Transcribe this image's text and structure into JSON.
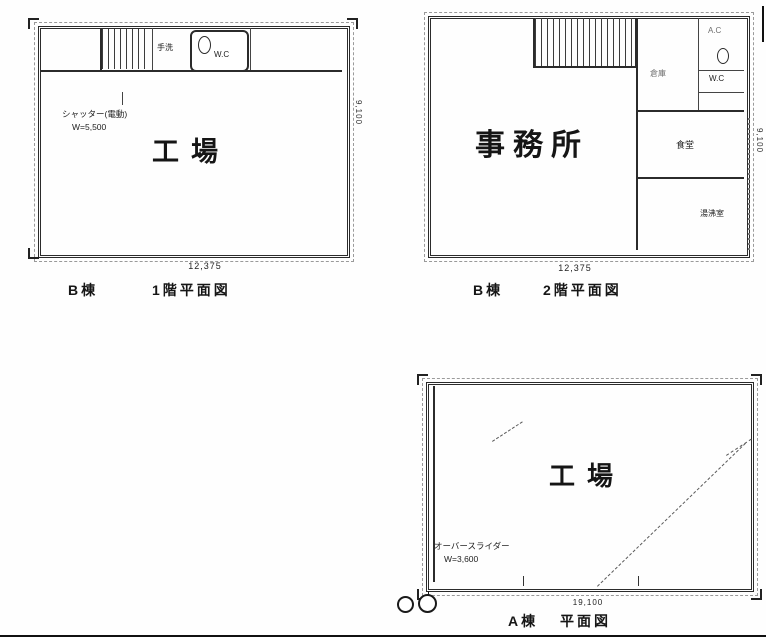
{
  "plans": {
    "b1": {
      "room": "工場",
      "note1": "シャッター(電動)",
      "note2": "W=5,500",
      "tearai": "手洗",
      "wc": "W.C",
      "dim_w": "12,375",
      "dim_h": "9,100",
      "building": "B棟",
      "title": "1階平面図"
    },
    "b2": {
      "room": "事務所",
      "store": "倉庫",
      "ac": "A.C",
      "wc": "W.C",
      "dining": "食堂",
      "kitchenette": "湯沸室",
      "dim_w": "12,375",
      "dim_h": "9,100",
      "building": "B棟",
      "title": "2階平面図"
    },
    "a": {
      "room": "工場",
      "note1": "オーバースライダー",
      "note2": "W=3,600",
      "dim_w": "19,100",
      "building": "A棟",
      "title": "平面図"
    }
  }
}
